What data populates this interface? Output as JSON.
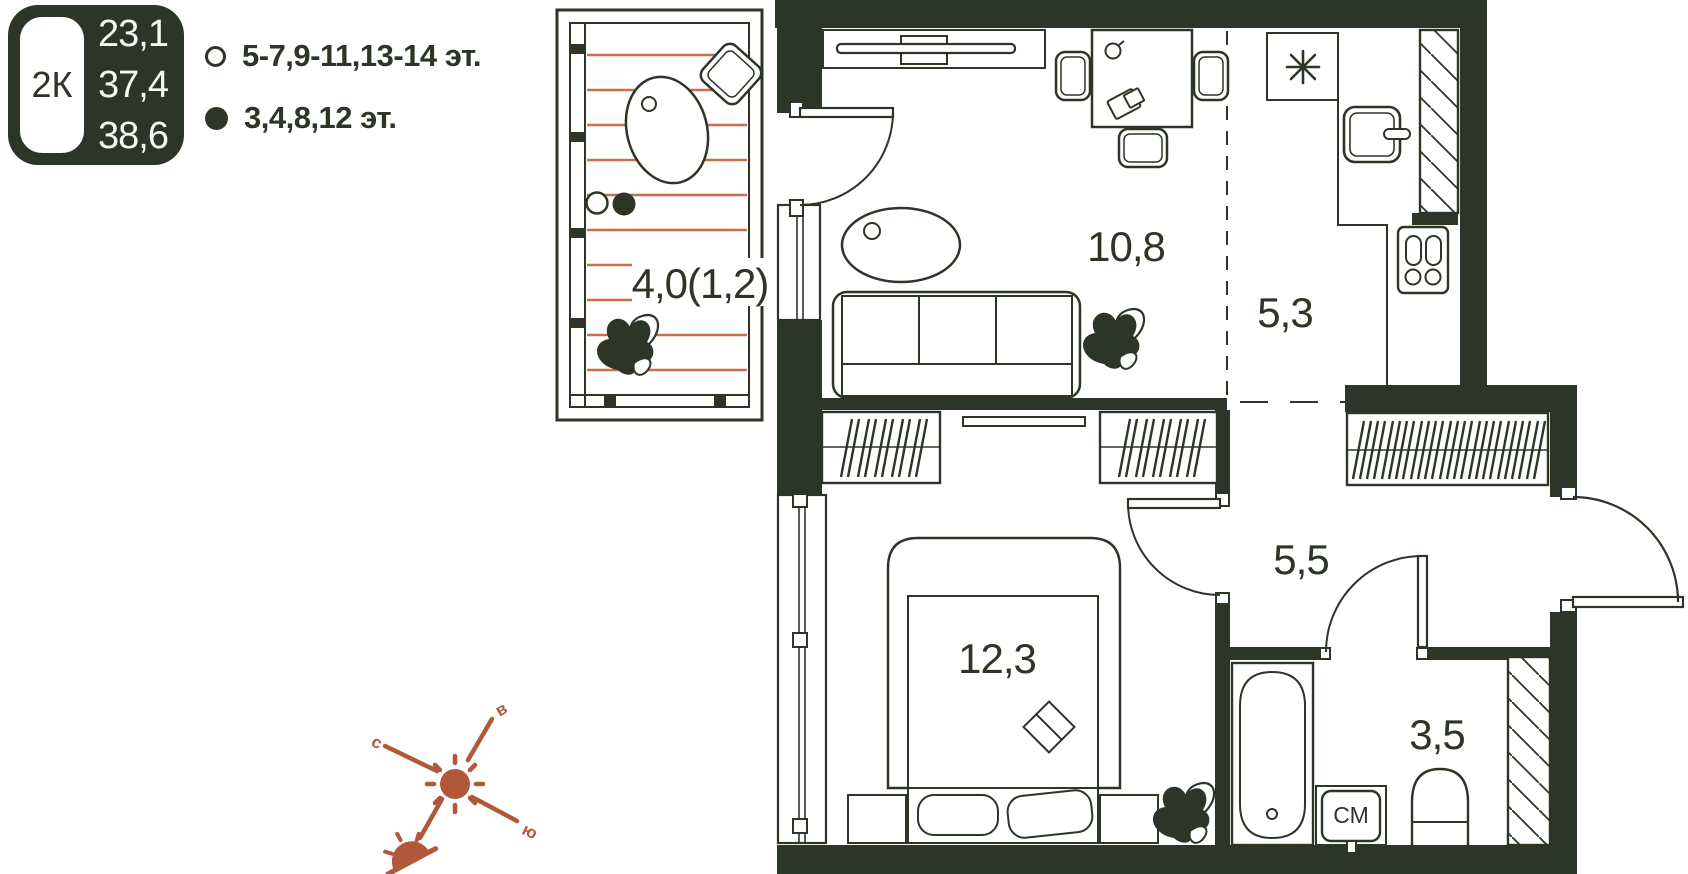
{
  "unit_badge": {
    "type_label": "2К",
    "areas": [
      "23,1",
      "37,4",
      "38,6"
    ]
  },
  "legend": {
    "items": [
      {
        "symbol": "circle-outline-icon",
        "label": "5-7,9-11,13-14 эт."
      },
      {
        "symbol": "circle-filled-icon",
        "label": "3,4,8,12 эт."
      }
    ]
  },
  "rooms": {
    "balcony": {
      "area_label": "4,0(1,2)"
    },
    "living": {
      "area_label": "10,8"
    },
    "kitchen": {
      "area_label": "5,3"
    },
    "hall": {
      "area_label": "5,5"
    },
    "bedroom": {
      "area_label": "12,3"
    },
    "bathroom": {
      "area_label": "3,5"
    }
  },
  "appliances": {
    "washing_machine_label": "СМ"
  },
  "compass": {
    "north": "с",
    "east": "в",
    "south": "ю"
  },
  "colors": {
    "ink": "#2d3527",
    "accent": "#b2583a",
    "deck_lines": "#c96f4a",
    "background": "#ffffff"
  }
}
